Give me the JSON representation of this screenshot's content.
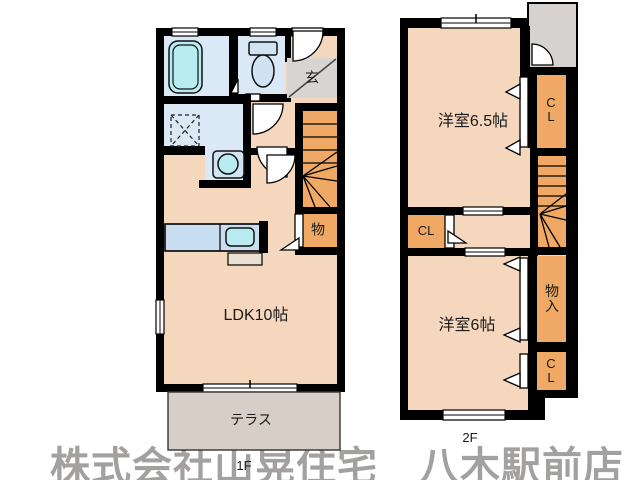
{
  "watermark": {
    "text": "株式会社山晃住宅　八木駅前店"
  },
  "floor1": {
    "label": "1F",
    "rooms": {
      "ldk": "LDK10帖",
      "entrance": "玄",
      "storage": "物",
      "terrace": "テラス"
    },
    "fixtures": [
      "bathtub-icon",
      "toilet-icon",
      "washbasin-icon",
      "kitchen-sink-icon",
      "washing-machine-pan-icon",
      "staircase-icon"
    ]
  },
  "floor2": {
    "label": "2F",
    "rooms": {
      "bedroom_65": "洋室6.5帖",
      "bedroom_6": "洋室6帖",
      "closet_upper": "CL",
      "closet_hall": "CL",
      "closet_lower": "CL",
      "storage": "物入"
    },
    "fixtures": [
      "staircase-icon"
    ]
  },
  "colors": {
    "wall": "#000000",
    "room": "#f4d7bc",
    "closet": "#efa964",
    "water_room": "#dbe8f5",
    "fixture": "#b9ecf1",
    "entrance_gray": "#d8d4d1",
    "terrace_gray": "#d6cec7",
    "alcove_gray": "#d6d2cf",
    "watermark_gray": "#a3a0a0"
  }
}
